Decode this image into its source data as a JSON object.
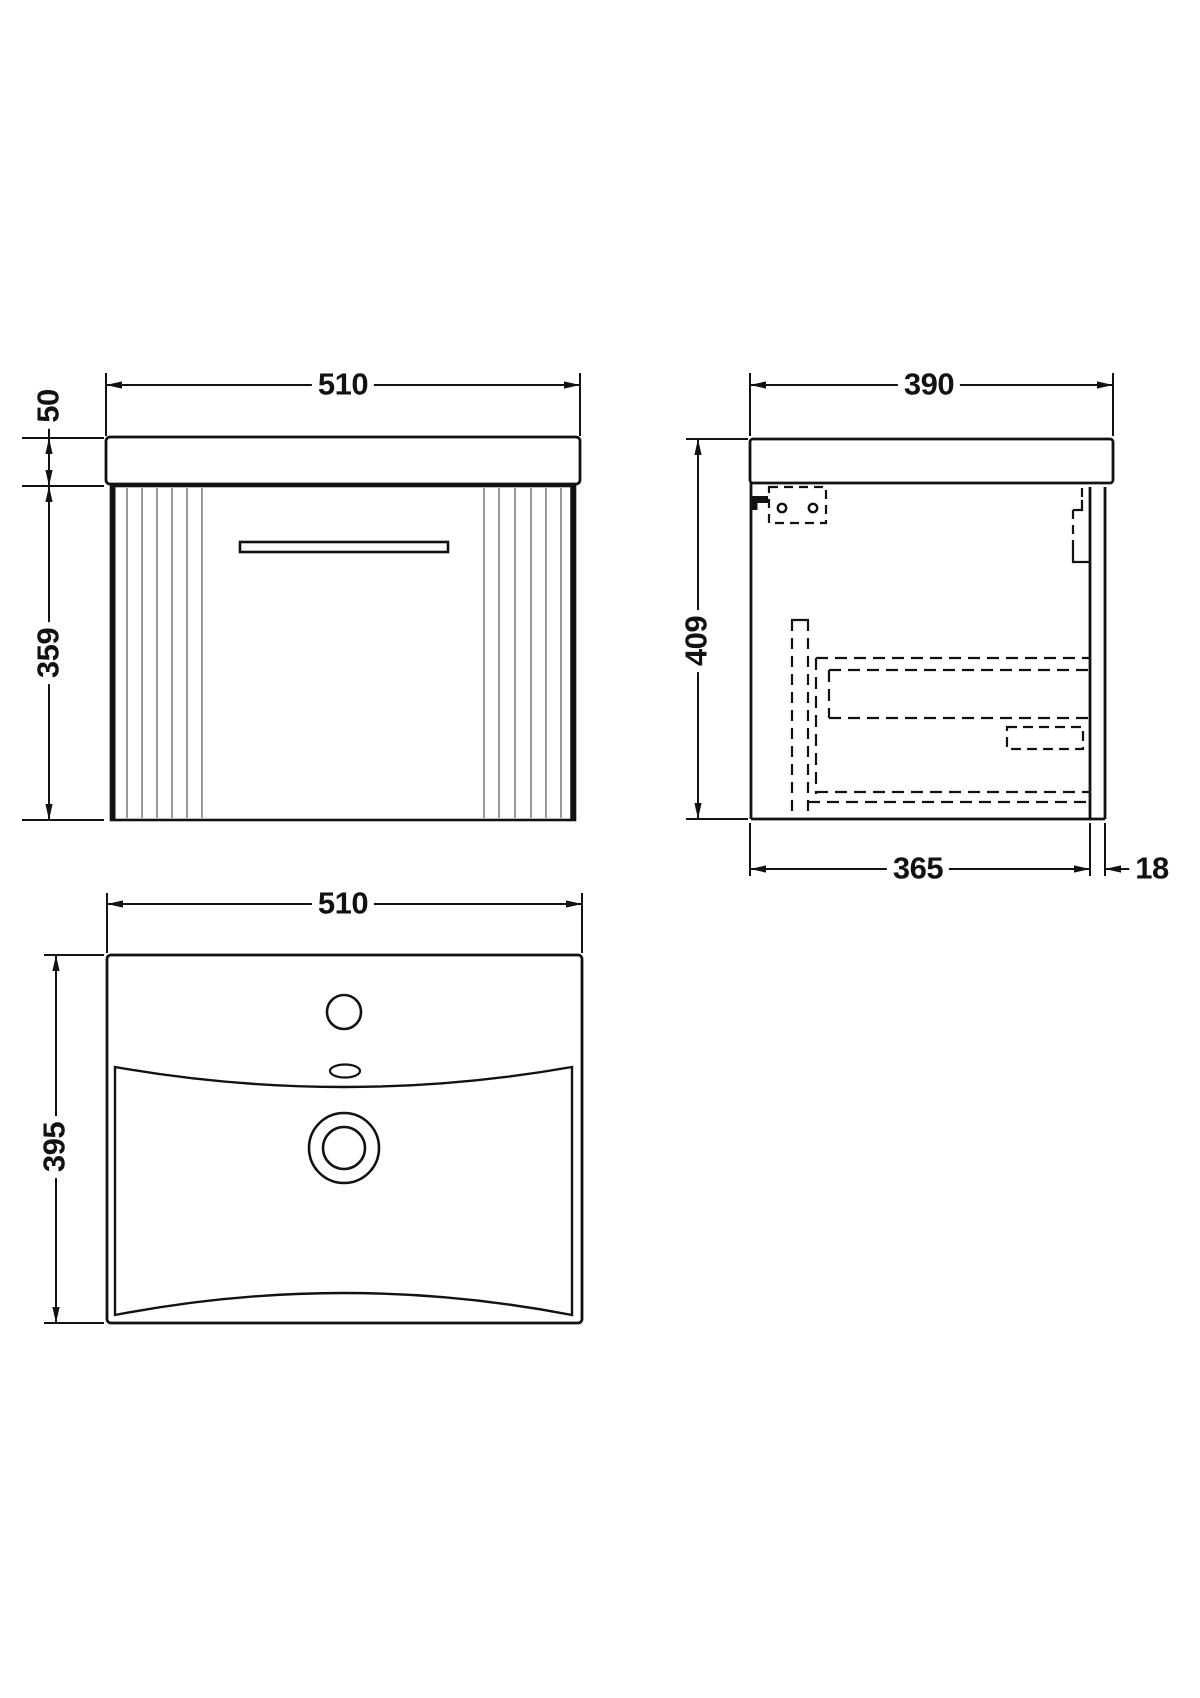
{
  "drawing": {
    "views": {
      "front": {
        "name": "front-view"
      },
      "side": {
        "name": "side-view"
      },
      "plan": {
        "name": "plan-view"
      }
    }
  },
  "dims": {
    "front_width": "510",
    "front_counter_height": "50",
    "front_cabinet_height": "359",
    "side_depth": "390",
    "side_height": "409",
    "side_body_depth": "365",
    "side_back_thickness": "18",
    "plan_width": "510",
    "plan_depth": "395"
  },
  "colors": {
    "line": "#121212",
    "flute": "#9b9b9b",
    "background": "#ffffff"
  }
}
